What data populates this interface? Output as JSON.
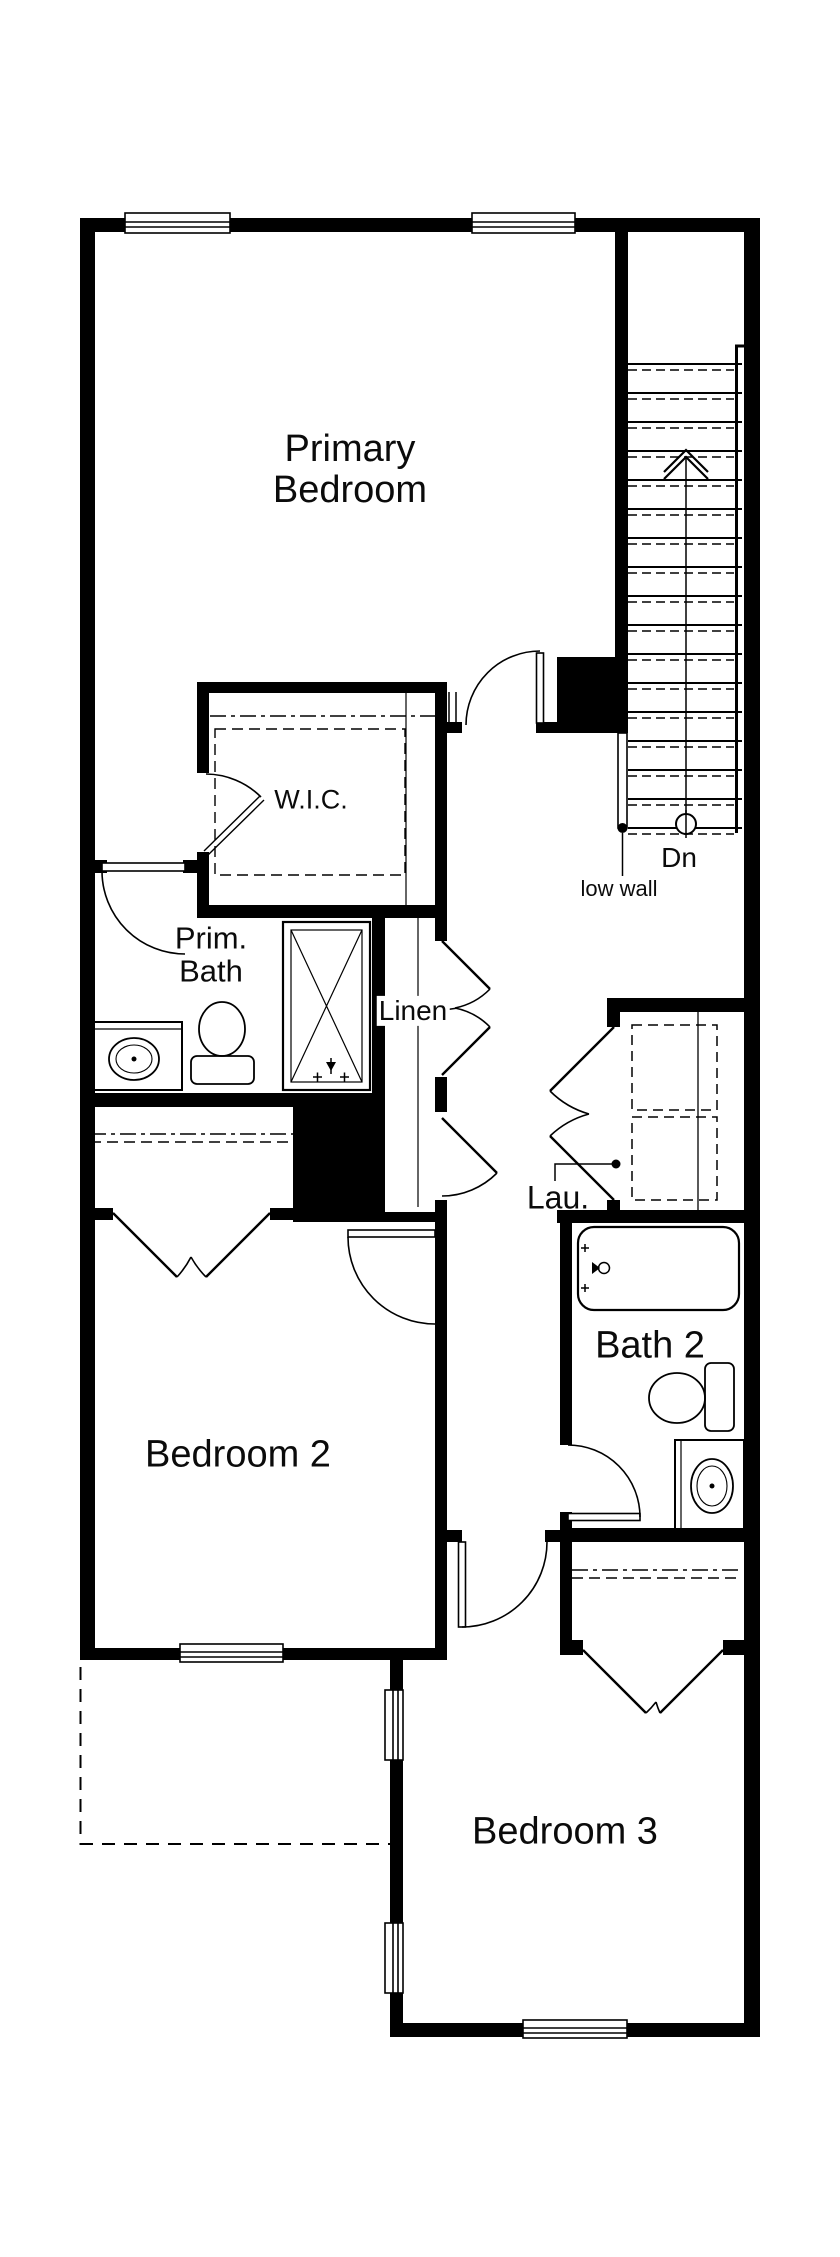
{
  "floor_plan": {
    "labels": {
      "primary_bedroom": "Primary Bedroom",
      "wic": "W.I.C.",
      "prim_bath": "Prim. Bath",
      "linen": "Linen",
      "laundry": "Lau.",
      "stair_direction": "Dn",
      "low_wall": "low wall",
      "bath2": "Bath 2",
      "bedroom2": "Bedroom 2",
      "bedroom3": "Bedroom 3"
    },
    "colors": {
      "wall": "#000000",
      "background": "#ffffff",
      "line": "#000000"
    },
    "features": [
      "stairs-down-17-treads",
      "low-wall-railing",
      "walk-in-closet-rod-shelf",
      "linen-closet-double-openings",
      "stacked-washer-dryer",
      "shower-x-symbol",
      "two-toilets",
      "two-vanity-sinks",
      "bathtub",
      "six-windows",
      "roof-outline-dashed",
      "double-closet-doors-bedroom2",
      "double-closet-doors-bedroom3"
    ]
  }
}
